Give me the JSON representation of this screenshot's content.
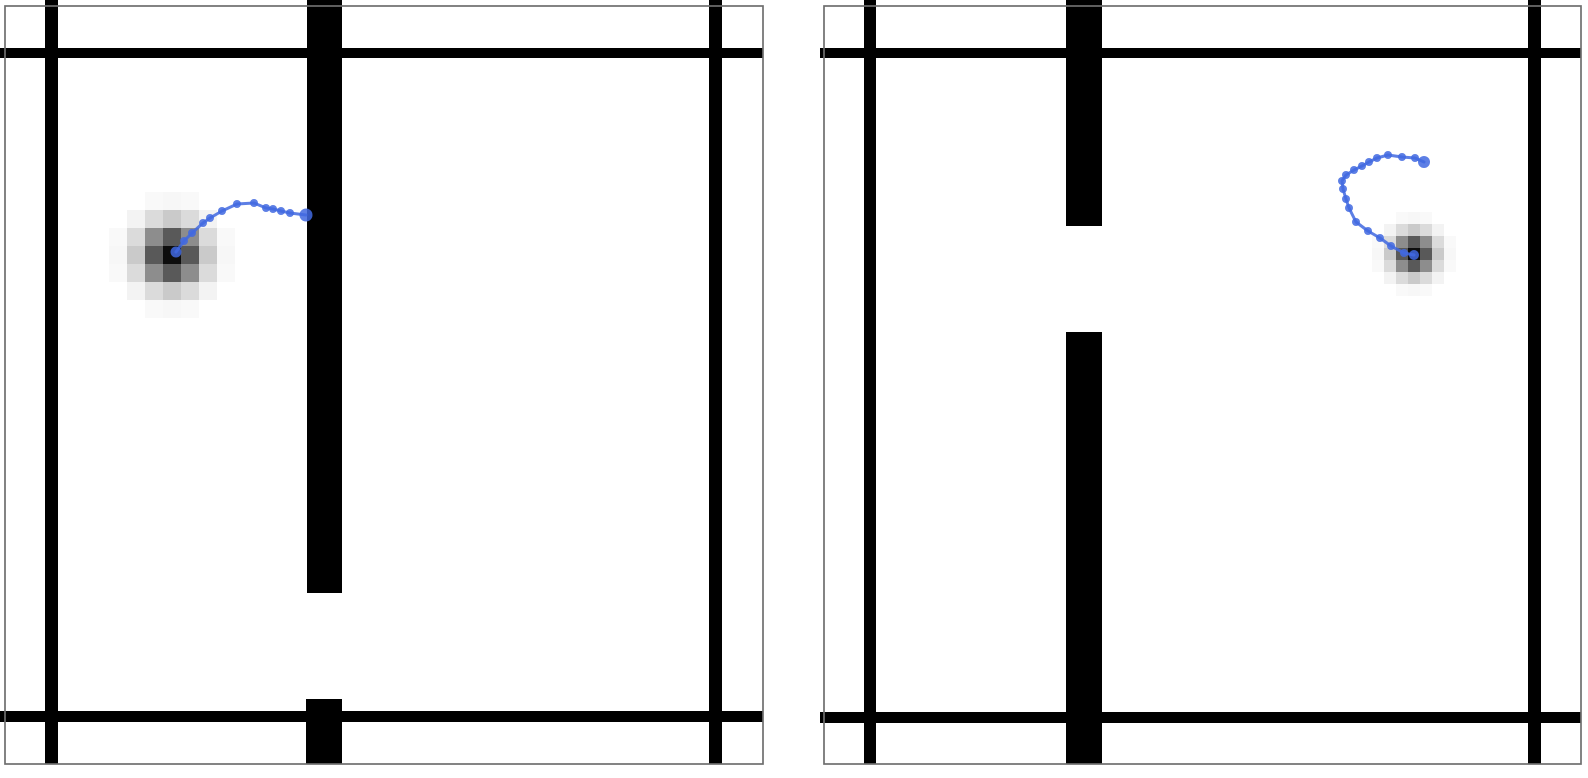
{
  "figure": {
    "width": 1588,
    "height": 778,
    "background": "#ffffff"
  },
  "chart_data": {
    "type": "scatter",
    "title": "",
    "description": "Two square maze environments side by side. Each shows black maze walls, a pixelated grayscale Gaussian goal-density blob, and a blue agent trajectory drawn as a dotted polyline.",
    "style": {
      "wall_color": "#000000",
      "frame_color": "#6e6e6e",
      "frame_width": 1.7,
      "trajectory_color": "#4169e1",
      "trajectory_opacity": 0.85,
      "dot_opacity": 0.85,
      "line_width": 3,
      "heat_color": "#000000"
    },
    "panels": [
      {
        "id": "maze-panel-left",
        "frame": {
          "x": 5,
          "y": 6,
          "w": 758,
          "h": 758
        },
        "walls": [
          {
            "id": "top-wall",
            "x": 0,
            "y": 48,
            "w": 763,
            "h": 10
          },
          {
            "id": "bottom-wall",
            "x": 0,
            "y": 711,
            "w": 763,
            "h": 11
          },
          {
            "id": "left-wall",
            "x": 45,
            "y": 0,
            "w": 13,
            "h": 764
          },
          {
            "id": "right-wall",
            "x": 709,
            "y": 0,
            "w": 13,
            "h": 764
          },
          {
            "id": "center-wall",
            "x": 307,
            "y": 0,
            "w": 35,
            "h": 593
          },
          {
            "id": "center-wall-stub",
            "x": 306,
            "y": 699,
            "w": 36,
            "h": 65
          }
        ],
        "goal_heatmap": {
          "cx": 172,
          "cy": 255,
          "cell_px": 18,
          "grid": 7,
          "sigma_cells": 1.15,
          "peak_opacity": 0.95
        },
        "trajectory": {
          "start_dot_radius": 6.5,
          "dot_radius": 4,
          "end_dot_radius": 5.5,
          "points": [
            [
              306,
              215
            ],
            [
              290,
              213
            ],
            [
              281,
              211
            ],
            [
              273,
              209
            ],
            [
              266,
              208
            ],
            [
              254,
              203
            ],
            [
              237,
              204
            ],
            [
              222,
              211
            ],
            [
              210,
              218
            ],
            [
              203,
              223
            ],
            [
              192,
              233
            ],
            [
              184,
              241
            ],
            [
              176,
              252
            ]
          ]
        }
      },
      {
        "id": "maze-panel-right",
        "frame": {
          "x": 824,
          "y": 6,
          "w": 757,
          "h": 758
        },
        "walls": [
          {
            "id": "top-wall",
            "x": 820,
            "y": 48,
            "w": 761,
            "h": 10
          },
          {
            "id": "bottom-wall",
            "x": 820,
            "y": 712,
            "w": 761,
            "h": 11
          },
          {
            "id": "left-wall",
            "x": 864,
            "y": 0,
            "w": 12,
            "h": 764
          },
          {
            "id": "right-wall",
            "x": 1528,
            "y": 0,
            "w": 13,
            "h": 764
          },
          {
            "id": "center-wall-top",
            "x": 1066,
            "y": 0,
            "w": 36,
            "h": 226
          },
          {
            "id": "center-wall-bottom",
            "x": 1066,
            "y": 332,
            "w": 36,
            "h": 432
          }
        ],
        "goal_heatmap": {
          "cx": 1414,
          "cy": 254,
          "cell_px": 12,
          "grid": 9,
          "sigma_cells": 1.15,
          "peak_opacity": 0.95
        },
        "trajectory": {
          "start_dot_radius": 6,
          "dot_radius": 4,
          "end_dot_radius": 5,
          "points": [
            [
              1424,
              162
            ],
            [
              1415,
              158
            ],
            [
              1402,
              157
            ],
            [
              1388,
              155
            ],
            [
              1377,
              158
            ],
            [
              1369,
              162
            ],
            [
              1362,
              166
            ],
            [
              1354,
              170
            ],
            [
              1346,
              175
            ],
            [
              1342,
              181
            ],
            [
              1343,
              189
            ],
            [
              1346,
              199
            ],
            [
              1349,
              208
            ],
            [
              1356,
              222
            ],
            [
              1368,
              231
            ],
            [
              1380,
              238
            ],
            [
              1391,
              246
            ],
            [
              1404,
              253
            ],
            [
              1414,
              255
            ]
          ]
        }
      }
    ]
  }
}
